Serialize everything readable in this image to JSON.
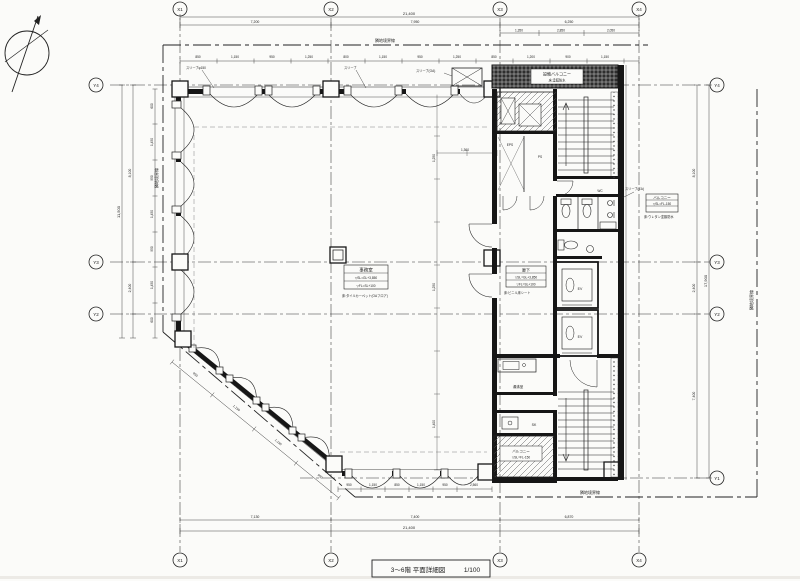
{
  "drawing": {
    "title": "3〜6階 平面詳細図",
    "scale": "1/100",
    "boundary_label": "隣地境界線"
  },
  "grid": {
    "x": [
      "X1",
      "X2",
      "X3",
      "X4"
    ],
    "y": [
      "Y4",
      "Y3",
      "Y2",
      "Y1"
    ]
  },
  "rooms": {
    "office": {
      "name": "事務室",
      "sl": "▽SL=GL+3,850",
      "fl": "▽FL=SL+100",
      "note": "床:タイルカーペット(OAフロア)"
    },
    "corridor": {
      "name": "廊下",
      "sl": "▽SL=GL+3,850",
      "fl": "▽FL=SL+100",
      "note": "床:ビニル床シート"
    },
    "balcony_right": {
      "name": "バルコニー",
      "sl": "▽SL=FL-150",
      "note": "床:ウレタン塗膜防水"
    },
    "balcony_bottom": {
      "name": "バルコニー",
      "sl": "▽SL=FL-150"
    },
    "equipment_balcony": {
      "name": "設備バルコニー",
      "note": "床:塗膜防水"
    },
    "kitchenette": "湯沸室",
    "slop_sink": "SK",
    "elevator": "EV",
    "wc": "WC",
    "eps": "EPS",
    "ps": "PS"
  },
  "callouts": {
    "sleeve1": "スリーブφ150",
    "sleeve2": "スリーブ",
    "sleeve3": "スリーブ(OA)",
    "sleeve4": "スリーブ(EA)"
  },
  "dims": {
    "top_total": "21,400",
    "top_seg": [
      "7,200",
      "7,950",
      "6,250"
    ],
    "top_sub": [
      "1,350",
      "2,850",
      "2,050"
    ],
    "top_win": [
      "850",
      "1,150",
      "950",
      "1,250",
      "800",
      "1,150",
      "950",
      "1,250",
      "850",
      "1,200",
      "900",
      "1,150"
    ],
    "bottom_seg": [
      "7,130",
      "7,400",
      "6,870"
    ],
    "bottom_total": "21,400",
    "bottom_win": [
      "950",
      "1,150",
      "850",
      "1,150",
      "950",
      "2,560"
    ],
    "left_seg": [
      "8,100",
      "2,400"
    ],
    "left_total": "11,500",
    "left_win": [
      "600",
      "1,450",
      "950",
      "1,450",
      "950",
      "1,450",
      "600"
    ],
    "right_seg": [
      "8,100",
      "2,400",
      "7,400"
    ],
    "right_total": "17,900",
    "diag_win": [
      "950",
      "1,150",
      "1,150",
      "950"
    ],
    "office_v": [
      "1,250",
      "1,250",
      "1,400"
    ],
    "office_h": "1,360"
  }
}
